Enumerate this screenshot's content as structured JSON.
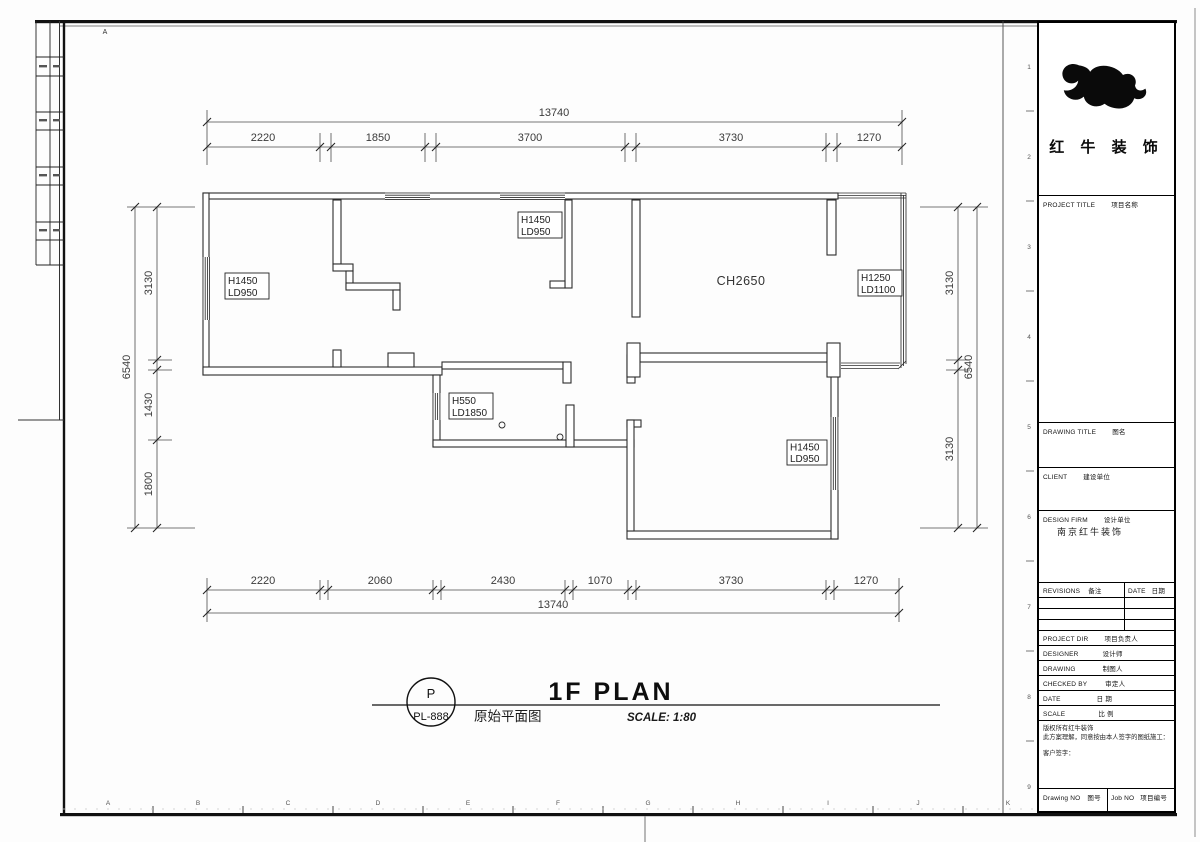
{
  "frame": {
    "top_marker": "A",
    "bottom_letters": [
      "A",
      "B",
      "C",
      "D",
      "E",
      "F",
      "G",
      "H",
      "I",
      "J",
      "K"
    ],
    "right_numbers": [
      "1",
      "2",
      "3",
      "4",
      "5",
      "6",
      "7",
      "8",
      "9"
    ]
  },
  "plan": {
    "room_height_label": "CH2650",
    "window_labels": {
      "left_wall": {
        "l1": "H1450",
        "l2": "LD950"
      },
      "top_wall": {
        "l1": "H1450",
        "l2": "LD950"
      },
      "bay_right": {
        "l1": "H1250",
        "l2": "LD1100"
      },
      "kitchen": {
        "l1": "H550",
        "l2": "LD1850"
      },
      "bottom_room": {
        "l1": "H1450",
        "l2": "LD950"
      }
    },
    "dims": {
      "top_total": "13740",
      "top_segments": [
        "2220",
        "1850",
        "3700",
        "3730",
        "1270"
      ],
      "bottom_segments": [
        "2220",
        "2060",
        "2430",
        "1070",
        "3730",
        "1270"
      ],
      "bottom_total": "13740",
      "left_total": "6540",
      "left_segments": [
        "3130",
        "1430",
        "1800"
      ],
      "right_segments": [
        "3130",
        "3130"
      ],
      "right_total": "6540"
    }
  },
  "title_bar": {
    "bubble_letter": "P",
    "bubble_code": "PL-888",
    "title_en": "1F PLAN",
    "title_cn": "原始平面图",
    "scale_text": "SCALE: 1:80"
  },
  "title_block": {
    "company_name": "红 牛 装 饰",
    "firm_value": "南京红牛装饰",
    "fields": {
      "project_title": {
        "en": "PROJECT TITLE",
        "cn": "项目名称"
      },
      "drawing_title": {
        "en": "DRAWING TITLE",
        "cn": "图名"
      },
      "client": {
        "en": "CLIENT",
        "cn": "建设单位"
      },
      "design_firm": {
        "en": "DESIGN FIRM",
        "cn": "设计单位"
      },
      "revisions": {
        "en": "REVISIONS",
        "cn": "备注"
      },
      "date_col": {
        "en": "DATE",
        "cn": "日期"
      },
      "project_dir": {
        "en": "PROJECT DIR",
        "cn": "项目负责人"
      },
      "designer": {
        "en": "DESIGNER",
        "cn": "设计师"
      },
      "drawing": {
        "en": "DRAWING",
        "cn": "制图人"
      },
      "checked_by": {
        "en": "CHECKED BY",
        "cn": "审定人"
      },
      "date_row": {
        "en": "DATE",
        "cn": "日 期"
      },
      "scale_row": {
        "en": "SCALE",
        "cn": "比 例"
      },
      "drawing_no": {
        "en": "Drawing NO",
        "cn": "图号"
      },
      "job_no": {
        "en": "Job NO",
        "cn": "项目编号"
      }
    },
    "notes": [
      "版权所有红牛装饰",
      "此方案理解，同意按由本人签字的图纸施工：",
      "客户签字："
    ]
  },
  "colors": {
    "line": "#2c2c2c",
    "dim_text": "#3a3a3a",
    "accent": "#000000"
  }
}
